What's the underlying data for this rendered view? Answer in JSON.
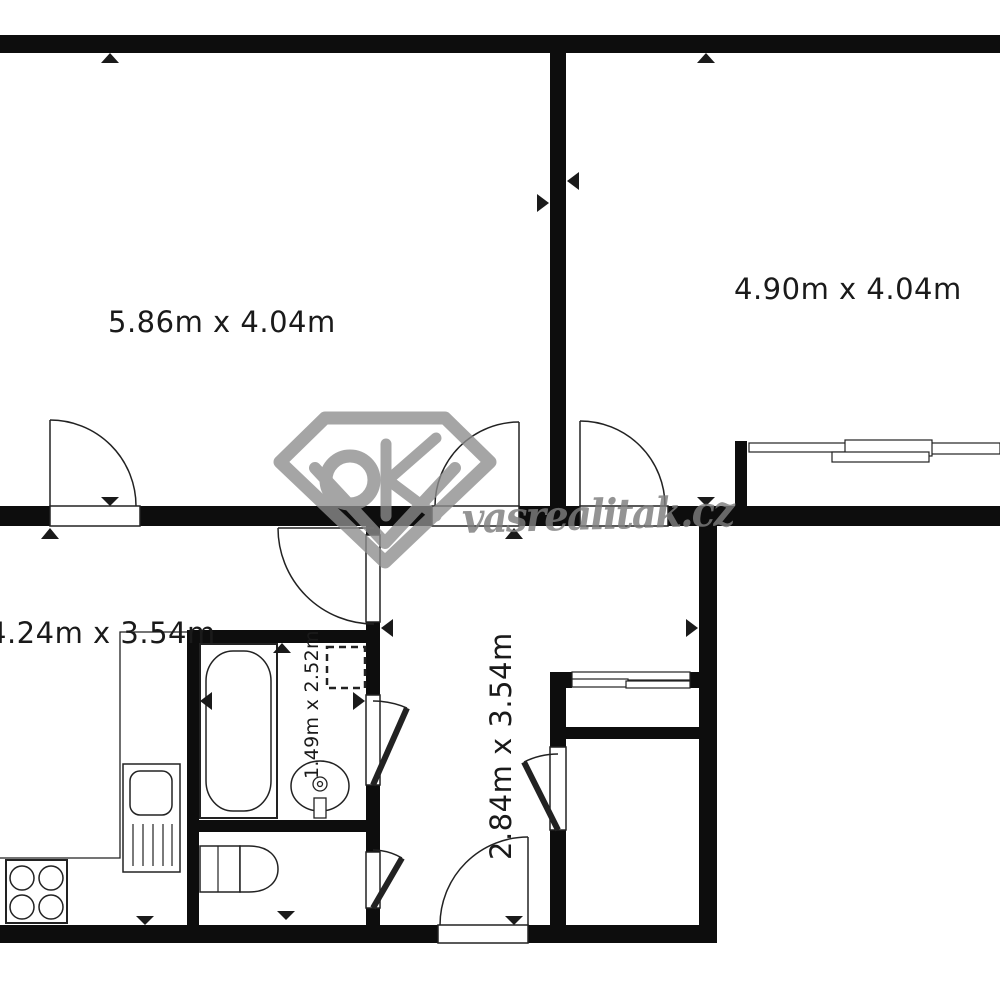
{
  "plan": {
    "type": "apartment-floor-plan",
    "watermark": {
      "text": "vasrealitak.cz"
    },
    "rooms": [
      {
        "id": "room-top-left",
        "label": "5.86m x 4.04m",
        "rotated": false
      },
      {
        "id": "room-top-right",
        "label": "4.90m x 4.04m",
        "rotated": false
      },
      {
        "id": "kitchen",
        "label": "4.24m x 3.54m",
        "rotated": false
      },
      {
        "id": "hall",
        "label": "2.84m x 3.54m",
        "rotated": true
      },
      {
        "id": "bathroom",
        "label": "1.49m x 2.52m",
        "rotated": true
      }
    ],
    "fixtures": [
      "bathtub-icon",
      "washbasin-icon",
      "washing-machine-icon",
      "toilet-icon",
      "kitchen-sink-icon",
      "stove-icon",
      "window-icon",
      "sliding-wardrobe-door-icon",
      "door-swing-icon",
      "measure-arrow-icon",
      "brand-gem-logo-icon"
    ],
    "colors": {
      "wall": "#0d0d0d",
      "line": "#222222",
      "background": "#ffffff",
      "watermark": "#8d8d8d"
    }
  }
}
